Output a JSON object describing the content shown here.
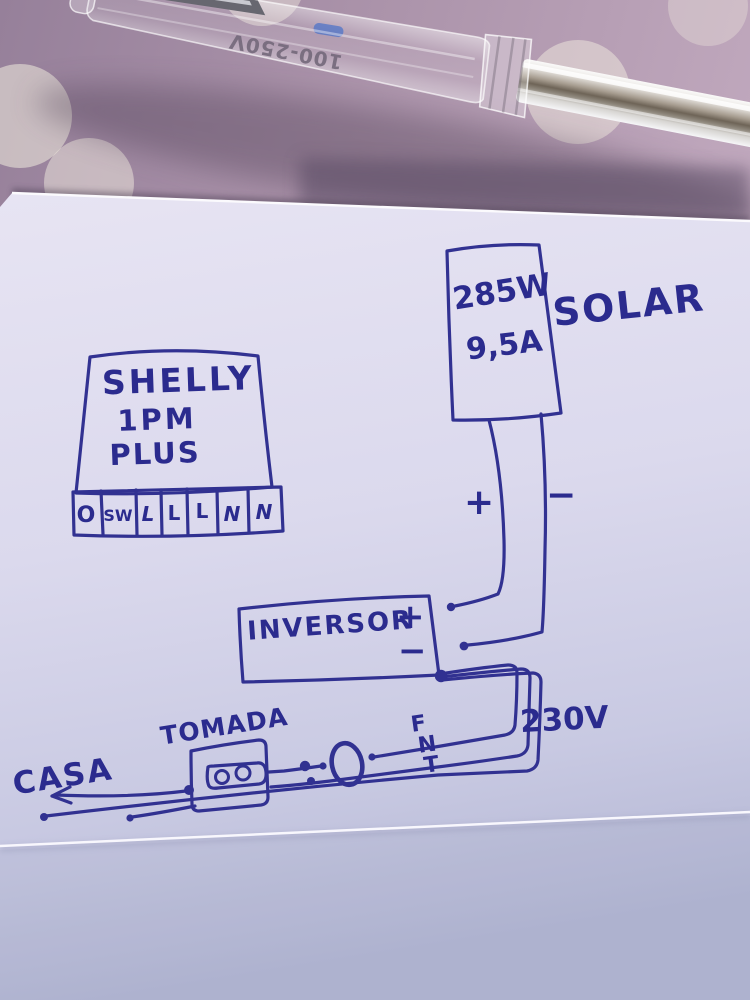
{
  "scene": {
    "background_color": "#ab93aa",
    "polka_dot_color": "#f1ecdf",
    "paper_color": "#e2e0f0",
    "ink_color": "#2b2b8e"
  },
  "tester": {
    "marking": "100-250V"
  },
  "diagram": {
    "shelly": {
      "title_line1": "SHELLY",
      "title_line2": "1PM",
      "title_line3": "PLUS",
      "terminals": [
        "O",
        "SW",
        "L",
        "L",
        "L",
        "N",
        "N"
      ]
    },
    "solar": {
      "power": "285W",
      "current": "9,5A",
      "label": "SOLAR",
      "plus_sign": "+",
      "minus_sign": "−"
    },
    "inverter": {
      "label": "INVERSOR",
      "plus_sign": "+",
      "minus_sign": "−"
    },
    "ac": {
      "voltage": "230V",
      "wire_labels": [
        "F",
        "N",
        "T"
      ]
    },
    "socket": {
      "label": "TOMADA"
    },
    "house": {
      "label": "CASA"
    }
  }
}
